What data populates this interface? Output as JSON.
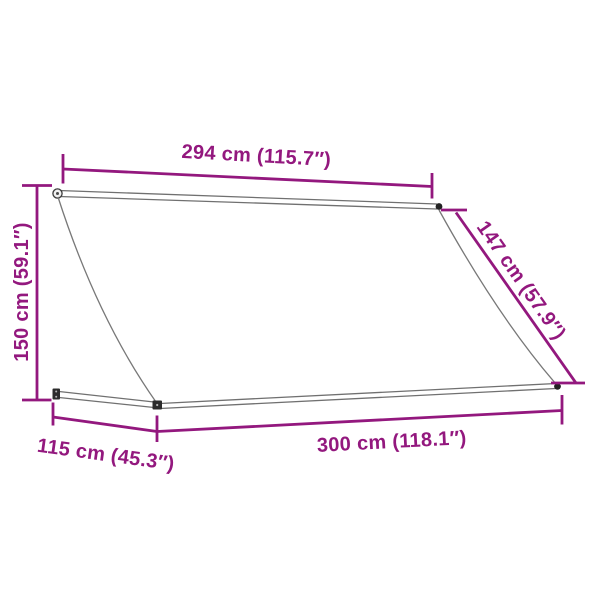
{
  "diagram": {
    "subject": "retractable-awning",
    "background_color": "#ffffff",
    "accent_color": "#93187E",
    "frame_line_color": "#707070",
    "cap_color": "#222222",
    "dimensions": {
      "fabric_width": {
        "label": "294 cm (115.7″)",
        "cm": 294,
        "inches": 115.7
      },
      "height": {
        "label": "150 cm (59.1″)",
        "cm": 150,
        "inches": 59.1
      },
      "side_length": {
        "label": "147 cm (57.9″)",
        "cm": 147,
        "inches": 57.9
      },
      "projection": {
        "label": "115 cm (45.3″)",
        "cm": 115,
        "inches": 45.3
      },
      "frame_width": {
        "label": "300 cm (118.1″)",
        "cm": 300,
        "inches": 118.1
      }
    }
  }
}
